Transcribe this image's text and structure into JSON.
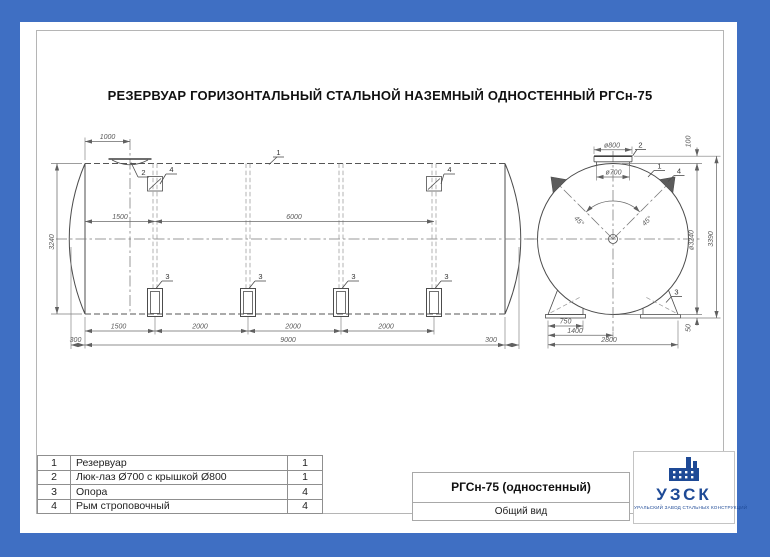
{
  "doc_title": "РЕЗЕРВУАР ГОРИЗОНТАЛЬНЫЙ СТАЛЬНОЙ НАЗЕМНЫЙ ОДНОСТЕННЫЙ РГСн-75",
  "callouts": {
    "tank": "1",
    "manhole": "2",
    "support": "3",
    "lug": "4"
  },
  "side_view": {
    "dims": {
      "manhole_offset": "1000",
      "left_span": "1500",
      "lug_span": "6000",
      "bottom_spans": [
        "1500",
        "2000",
        "2000",
        "2000"
      ],
      "cone_length": "300",
      "total_length": "9000",
      "shell_height": "3240"
    }
  },
  "end_view": {
    "dims": {
      "cover_diameter": "ø800",
      "neck_diameter": "ø700",
      "cover_height": "100",
      "shell_diameter": "ø3240",
      "total_height": "3390",
      "support_height": "50",
      "lug_angle": "45°",
      "support_width": "750",
      "support_offset": "1400",
      "support_span": "2800"
    }
  },
  "parts_table": {
    "rows": [
      {
        "pos": "1",
        "name": "Резервуар",
        "qty": "1"
      },
      {
        "pos": "2",
        "name": "Люк-лаз Ø700 с крышкой Ø800",
        "qty": "1"
      },
      {
        "pos": "3",
        "name": "Опора",
        "qty": "4"
      },
      {
        "pos": "4",
        "name": "Рым строповочный",
        "qty": "4"
      }
    ]
  },
  "title_block": {
    "model": "РГСн-75 (одностенный)",
    "view_name": "Общий вид"
  },
  "logo": {
    "abbr": "УЗСК",
    "subtitle": "УРАЛЬСКИЙ ЗАВОД СТАЛЬНЫХ КОНСТРУКЦИЙ"
  },
  "colors": {
    "border_blue": "#3f6fc3",
    "logo_blue": "#1e4a96",
    "line_gray": "#4c4c4c"
  }
}
